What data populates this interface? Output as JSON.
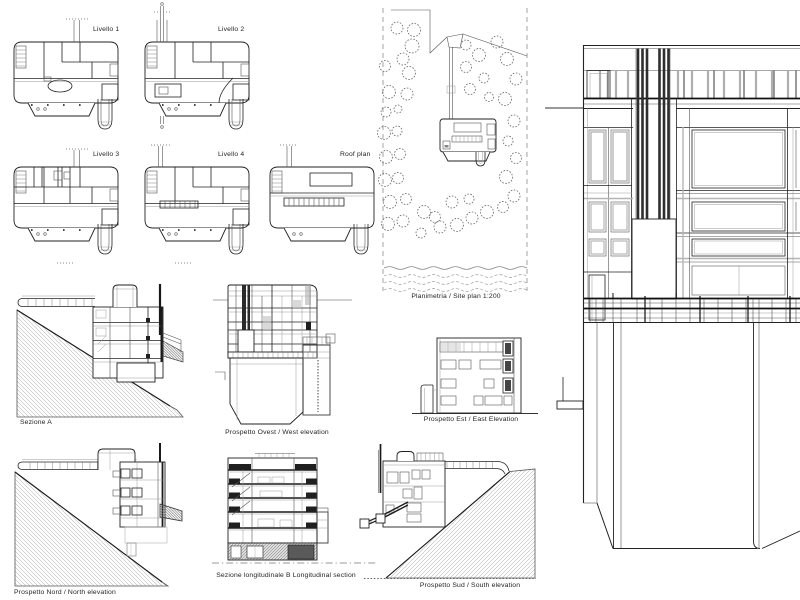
{
  "sheet": {
    "type": "architectural-presentation-sheet",
    "background": "#ffffff",
    "ink_color": "#222222",
    "hatch_color": "#b5b5b5",
    "accent_gray": "#999999"
  },
  "labels": {
    "livello1": "Livello 1",
    "livello2": "Livello 2",
    "livello3": "Livello 3",
    "livello4": "Livello 4",
    "roof_plan": "Roof plan",
    "site_plan": "Planimetria  /  Site plan 1:200",
    "sezione_a": "Sezione A",
    "west_elevation": "Prospetto Ovest  /  West elevation",
    "east_elevation": "Prospetto Est  /  East Elevation",
    "north_elevation": "Prospetto Nord  /  North elevation",
    "longitudinal_section": "Sezione longitudinale  B  Longitudinal section",
    "south_elevation": "Prospetto Sud  /  South elevation"
  }
}
